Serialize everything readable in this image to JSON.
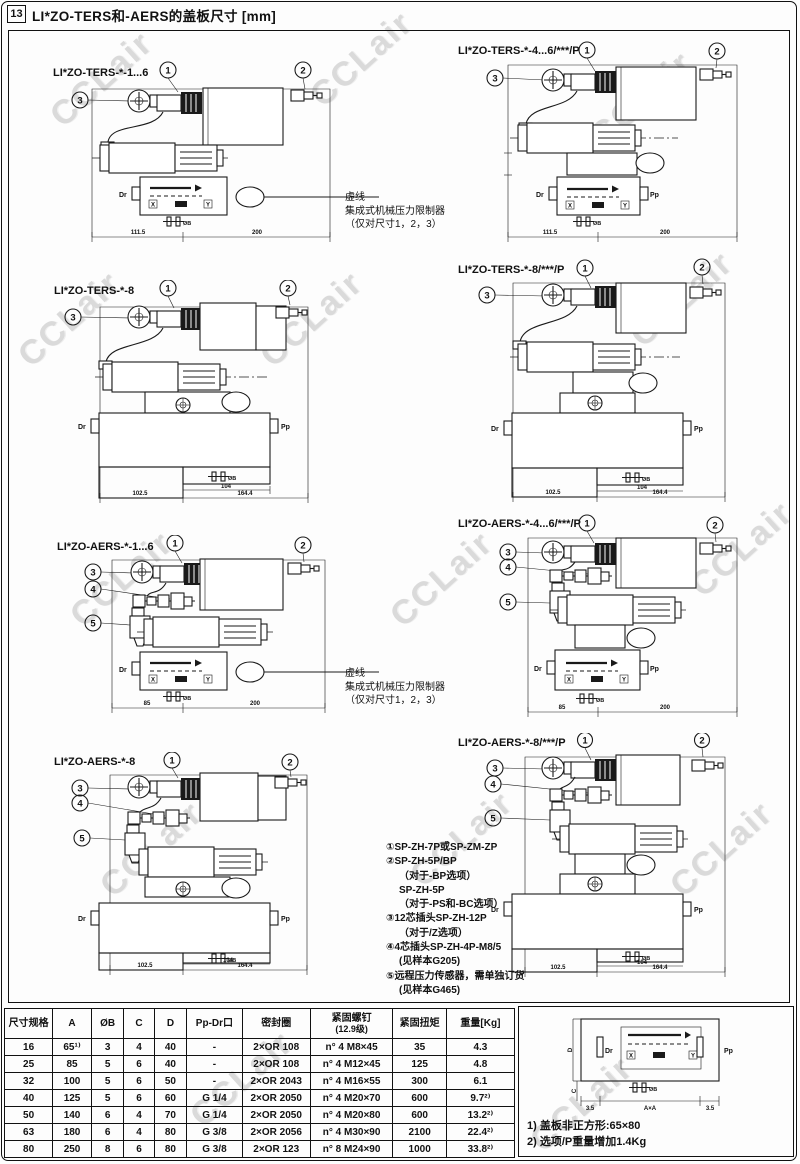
{
  "page": {
    "tag": "13",
    "title": "LI*ZO-TERS和-AERS的盖板尺寸 [mm]",
    "watermark": "CCLair"
  },
  "labels": {
    "dr": "Dr",
    "pp": "Pp",
    "hole": "ØB",
    "x": "X",
    "y": "Y"
  },
  "pressure_note": {
    "l1": "虚线",
    "l2": "集成式机械压力限制器",
    "l3": "（仅对尺寸1，2，3）"
  },
  "parts_list": {
    "lines": [
      "①SP-ZH-7P或SP-ZM-ZP",
      "②SP-ZH-5P/BP",
      "（对于-BP选项）",
      "SP-ZH-5P",
      "（对于-PS和-BC选项）",
      "③12芯插头SP-ZH-12P",
      "（对于/Z选项）",
      "④4芯插头SP-ZH-4P-M8/5",
      "(见样本G205)",
      "⑤远程压力传感器，需单独订货",
      "(见样本G465)"
    ]
  },
  "diagrams": [
    {
      "title": "LI*ZO-TERS-*-1...6",
      "c1": "1",
      "c2": "2",
      "c3": "3",
      "dim1": "111.5",
      "dim2": "200"
    },
    {
      "title": "LI*ZO-TERS-*-4...6/***/P",
      "c1": "1",
      "c2": "2",
      "c3": "3",
      "dim1": "111.5",
      "dim2": "200"
    },
    {
      "title": "LI*ZO-TERS-*-8",
      "c1": "1",
      "c2": "2",
      "c3": "3",
      "dim1": "102.5",
      "dim2": "104",
      "dim3": "164.4"
    },
    {
      "title": "LI*ZO-TERS-*-8/***/P",
      "c1": "1",
      "c2": "2",
      "c3": "3",
      "dim1": "102.5",
      "dim2": "104",
      "dim3": "164.4"
    },
    {
      "title": "LI*ZO-AERS-*-1...6",
      "c1": "1",
      "c2": "2",
      "c3": "3",
      "c4": "4",
      "c5": "5",
      "dim1": "85",
      "dim2": "200"
    },
    {
      "title": "LI*ZO-AERS-*-4...6/***/P",
      "c1": "1",
      "c2": "2",
      "c3": "3",
      "c4": "4",
      "c5": "5",
      "dim1": "85",
      "dim2": "200"
    },
    {
      "title": "LI*ZO-AERS-*-8",
      "c1": "1",
      "c2": "2",
      "c3": "3",
      "c4": "4",
      "c5": "5",
      "dim1": "102.5",
      "dim2": "104",
      "dim3": "164.4"
    },
    {
      "title": "LI*ZO-AERS-*-8/***/P",
      "c1": "1",
      "c2": "2",
      "c3": "3",
      "c4": "4",
      "c5": "5",
      "dim1": "102.5",
      "dim2": "104",
      "dim3": "164.4"
    }
  ],
  "table": {
    "headers": [
      "尺寸规格",
      "A",
      "ØB",
      "C",
      "D",
      "Pp-Dr口",
      "密封圈",
      "紧固螺钉",
      "紧固扭矩",
      "重量[Kg]"
    ],
    "header_sub": "(12.9级)",
    "rows": [
      [
        "16",
        "65¹⁾",
        "3",
        "4",
        "40",
        "-",
        "2×OR 108",
        "n° 4 M8×45",
        "35",
        "4.3"
      ],
      [
        "25",
        "85",
        "5",
        "6",
        "40",
        "-",
        "2×OR 108",
        "n° 4 M12×45",
        "125",
        "4.8"
      ],
      [
        "32",
        "100",
        "5",
        "6",
        "50",
        "-",
        "2×OR 2043",
        "n° 4 M16×55",
        "300",
        "6.1"
      ],
      [
        "40",
        "125",
        "5",
        "6",
        "60",
        "G 1/4",
        "2×OR 2050",
        "n° 4 M20×70",
        "600",
        "9.7²⁾"
      ],
      [
        "50",
        "140",
        "6",
        "4",
        "70",
        "G 1/4",
        "2×OR 2050",
        "n° 4 M20×80",
        "600",
        "13.2²⁾"
      ],
      [
        "63",
        "180",
        "6",
        "4",
        "80",
        "G 3/8",
        "2×OR 2056",
        "n° 4 M30×90",
        "2100",
        "22.4²⁾"
      ],
      [
        "80",
        "250",
        "8",
        "6",
        "80",
        "G 3/8",
        "2×OR 123",
        "n° 8 M24×90",
        "1000",
        "33.8²⁾"
      ]
    ]
  },
  "cover_diagram": {
    "dim_left": "3.5",
    "dim_center": "A×A",
    "dim_right": "3.5",
    "dim_d": "D",
    "dim_c": "C"
  },
  "footnotes": {
    "n1": "1) 盖板非正方形:65×80",
    "n2": "2) 选项/P重量增加1.4Kg"
  }
}
